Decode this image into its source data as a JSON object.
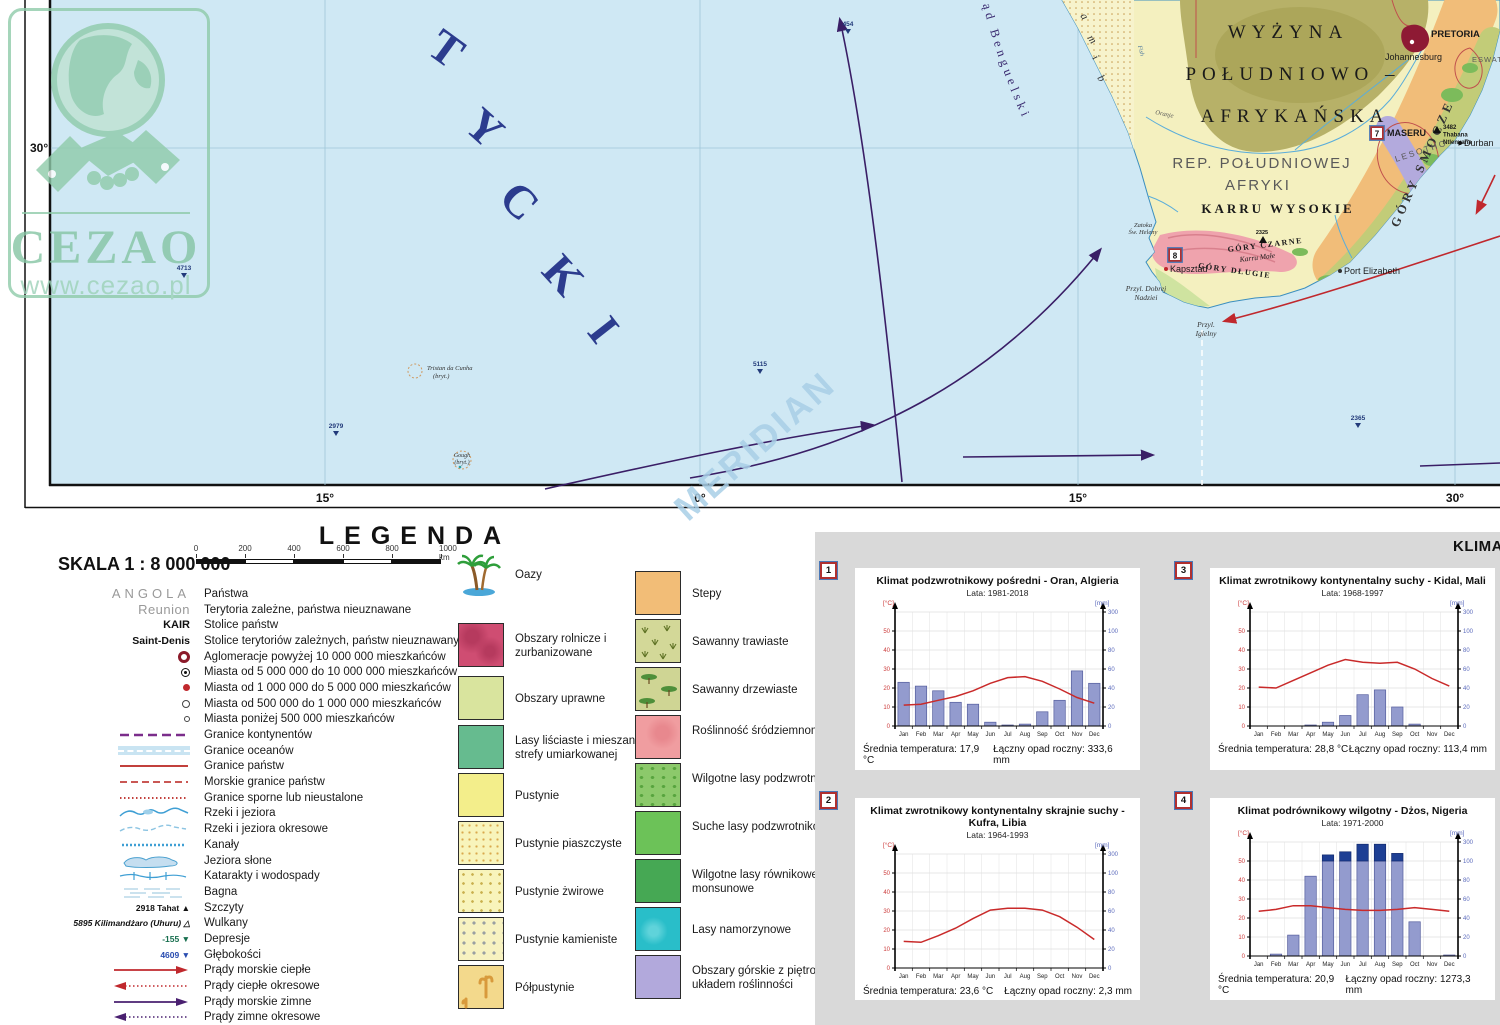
{
  "watermarks": {
    "brand": "CEZAO",
    "url": "www.cezao.pl",
    "meridian": "MERIDIAN"
  },
  "map": {
    "ocean_letters": [
      "T",
      "Y",
      "C",
      "K",
      "I"
    ],
    "namib_letters": [
      "a",
      "m",
      "i",
      "b"
    ],
    "axis": {
      "lat": "30°",
      "lon": [
        "15°",
        "0°",
        "15°",
        "30°"
      ]
    },
    "depths": [
      {
        "value": "454"
      },
      {
        "value": "4713"
      },
      {
        "value": "2979"
      },
      {
        "value": "5115"
      },
      {
        "value": "2365"
      }
    ],
    "labels": {
      "current": "Prąd Benguelski",
      "region1": "WYŻYNA",
      "region2": "POŁUDNIOWO –",
      "region3": "AFRYKAŃSKA",
      "country1": "REP. POŁUDNIOWEJ",
      "country2": "AFRYKI",
      "karru": "KARRU WYSOKIE",
      "smocze": "GÓRY SMOCZE",
      "dlugie": "GÓRY DŁUGIE",
      "czarne": "GÓRY CZARNE",
      "karru_male": "Karru Małe",
      "pretoria": "PRETORIA",
      "johannesburg": "Johannesburg",
      "maseru": "MASERU",
      "lesotho": "LESOTHO",
      "thabana_elev": "3482",
      "thabana_l1": "Thabana",
      "thabana_l2": "Ntlenyana",
      "eswatini": "ESWATINI",
      "durban": "Durban",
      "port_elizabeth": "Port Elizabeth",
      "kapsztad": "Kapsztad",
      "przyl_dobrej_l1": "Przyl. Dobrej",
      "przyl_dobrej_l2": "Nadziei",
      "przyl_igielny_l1": "Przyl.",
      "przyl_igielny_l2": "Igielny",
      "zatoka_l1": "Zatoka",
      "zatoka_l2": "Św. Heleny",
      "tristan_l1": "Tristan da Cunha",
      "tristan_l2": "(bryt.)",
      "gough_l1": "Gough",
      "gough_l2": "(bryt.)",
      "fish": "Fish",
      "oranje": "Oranje",
      "peak_2325": "2325",
      "badge7": "7",
      "badge8": "8"
    },
    "colors": {
      "ocean": "#cfe8f4",
      "land": "#f4f0bf",
      "warm_current": "#c0282d",
      "cold_current": "#3a1e66"
    }
  },
  "legend": {
    "title": "LEGENDA",
    "scale_label": "SKALA 1 : 8 000 000",
    "scale_ticks": [
      "0",
      "200",
      "400",
      "600",
      "800",
      "1000 km"
    ],
    "symbols": [
      {
        "symbol": "ANGOLA",
        "label": "Państwa"
      },
      {
        "symbol": "Reunion",
        "label": "Terytoria zależne, państwa nieuznawane"
      },
      {
        "symbol": "KAIR",
        "label": "Stolice państw"
      },
      {
        "symbol": "Saint-Denis",
        "label": "Stolice terytoriów zależnych, państw nieuznawanych"
      },
      {
        "label": "Aglomeracje powyżej 10 000 000 mieszkańców"
      },
      {
        "label": "Miasta od 5 000 000 do 10 000 000 mieszkańców"
      },
      {
        "label": "Miasta od 1 000 000 do 5 000 000 mieszkańców"
      },
      {
        "label": "Miasta od 500 000 do 1 000 000 mieszkańców"
      },
      {
        "label": "Miasta poniżej 500 000 mieszkańców"
      },
      {
        "label": "Granice kontynentów"
      },
      {
        "label": "Granice oceanów"
      },
      {
        "label": "Granice państw"
      },
      {
        "label": "Morskie granice państw"
      },
      {
        "label": "Granice sporne lub nieustalone"
      },
      {
        "label": "Rzeki i jeziora"
      },
      {
        "label": "Rzeki i jeziora okresowe"
      },
      {
        "label": "Kanały"
      },
      {
        "label": "Jeziora słone"
      },
      {
        "label": "Katarakty i wodospady"
      },
      {
        "label": "Bagna"
      },
      {
        "symbol": "2918 Tahat ▲",
        "label": "Szczyty"
      },
      {
        "symbol": "5895 Kilimandżaro (Uhuru) △",
        "label": "Wulkany"
      },
      {
        "symbol": "-155 ▼",
        "label": "Depresje"
      },
      {
        "symbol": "4609 ▼",
        "label": "Głębokości"
      },
      {
        "label": "Prądy morskie ciepłe"
      },
      {
        "label": "Prądy ciepłe okresowe"
      },
      {
        "label": "Prądy morskie zimne"
      },
      {
        "label": "Prądy zimne okresowe"
      }
    ],
    "veg_col1": [
      "Oazy",
      "Obszary rolnicze i zurbanizowane",
      "Obszary uprawne",
      "Lasy liściaste i mieszane strefy umiarkowanej",
      "Pustynie",
      "Pustynie piaszczyste",
      "Pustynie żwirowe",
      "Pustynie kamieniste",
      "Półpustynie"
    ],
    "veg_col2": [
      "Stepy",
      "Sawanny trawiaste",
      "Sawanny drzewiaste",
      "Roślinność śródziemnomorska",
      "Wilgotne lasy podzwrotnikowe",
      "Suche lasy podzwrotnikowe",
      "Wilgotne lasy równikowe i monsunowe",
      "Lasy namorzynowe",
      "Obszary górskie z piętrowym układem roślinności"
    ]
  },
  "climate": {
    "header": "KLIMA"
  },
  "chart_data": [
    {
      "type": "bar+line climograph",
      "badge": "1",
      "title": "Klimat podzwrotnikowy pośredni - Oran, Algieria",
      "years": "Lata: 1981-2018",
      "months": [
        "Jan",
        "Feb",
        "Mar",
        "Apr",
        "May",
        "Jun",
        "Jul",
        "Aug",
        "Sep",
        "Oct",
        "Nov",
        "Dec"
      ],
      "temp_c": [
        11,
        11.5,
        13.5,
        15.5,
        18.5,
        22.5,
        25.5,
        26,
        23.5,
        19.5,
        15,
        12
      ],
      "precip_mm": [
        46,
        42,
        37,
        25,
        23,
        4,
        1,
        2,
        15,
        27,
        58,
        45
      ],
      "avg_temp_label": "Średnia temperatura: 17,9 °C",
      "precip_total_label": "Łączny opad roczny: 333,6 mm",
      "y_left_unit": "[°C]",
      "y_right_unit": "[mm]",
      "left_ticks": [
        0,
        10,
        20,
        30,
        40,
        50
      ],
      "right_ticks": [
        0,
        20,
        40,
        60,
        80,
        100,
        300
      ]
    },
    {
      "type": "bar+line climograph",
      "badge": "3",
      "title": "Klimat zwrotnikowy kontynentalny suchy - Kidal, Mali",
      "years": "Lata: 1968-1997",
      "months": [
        "Jan",
        "Feb",
        "Mar",
        "Apr",
        "May",
        "Jun",
        "Jul",
        "Aug",
        "Sep",
        "Oct",
        "Nov",
        "Dec"
      ],
      "temp_c": [
        20.5,
        20,
        24,
        28,
        32,
        35,
        33.5,
        33,
        33.5,
        30,
        25,
        21
      ],
      "precip_mm": [
        0,
        0,
        0,
        1,
        4,
        11,
        33,
        38,
        20,
        2,
        0,
        0
      ],
      "avg_temp_label": "Średnia temperatura: 28,8 °C",
      "precip_total_label": "Łączny opad roczny: 113,4 mm",
      "y_left_unit": "[°C]",
      "y_right_unit": "[mm]",
      "left_ticks": [
        0,
        10,
        20,
        30,
        40,
        50
      ],
      "right_ticks": [
        0,
        20,
        40,
        60,
        80,
        100,
        300
      ]
    },
    {
      "type": "bar+line climograph",
      "badge": "2",
      "title": "Klimat zwrotnikowy kontynentalny skrajnie suchy - Kufra, Libia",
      "years": "Lata: 1964-1993",
      "months": [
        "Jan",
        "Feb",
        "Mar",
        "Apr",
        "May",
        "Jun",
        "Jul",
        "Aug",
        "Sep",
        "Oct",
        "Nov",
        "Dec"
      ],
      "temp_c": [
        14,
        13.5,
        17,
        21,
        26,
        30.5,
        31.5,
        31.5,
        30.5,
        27,
        21.5,
        15
      ],
      "precip_mm": [
        0,
        0,
        0,
        0,
        0,
        0,
        0,
        0,
        0,
        0,
        0,
        0
      ],
      "avg_temp_label": "Średnia temperatura: 23,6 °C",
      "precip_total_label": "Łączny opad roczny: 2,3 mm",
      "y_left_unit": "[°C]",
      "y_right_unit": "[mm]",
      "left_ticks": [
        0,
        10,
        20,
        30,
        40,
        50
      ],
      "right_ticks": [
        0,
        20,
        40,
        60,
        80,
        100,
        300
      ]
    },
    {
      "type": "bar+line climograph",
      "badge": "4",
      "title": "Klimat podrównikowy wilgotny - Dżos, Nigeria",
      "years": "Lata: 1971-2000",
      "months": [
        "Jan",
        "Feb",
        "Mar",
        "Apr",
        "May",
        "Jun",
        "Jul",
        "Aug",
        "Sep",
        "Oct",
        "Nov",
        "Dec"
      ],
      "temp_c": [
        23.5,
        24.5,
        26.5,
        26.5,
        25.5,
        24.5,
        24,
        24,
        24.5,
        25.5,
        24.5,
        23.5
      ],
      "precip_mm": [
        0,
        2,
        22,
        84,
        164,
        197,
        277,
        277,
        180,
        36,
        0,
        1
      ],
      "avg_temp_label": "Średnia temperatura: 20,9 °C",
      "precip_total_label": "Łączny opad roczny: 1273,3 mm",
      "y_left_unit": "[°C]",
      "y_right_unit": "[mm]",
      "left_ticks": [
        0,
        10,
        20,
        30,
        40,
        50
      ],
      "right_ticks": [
        0,
        20,
        40,
        60,
        80,
        100,
        300
      ]
    }
  ]
}
